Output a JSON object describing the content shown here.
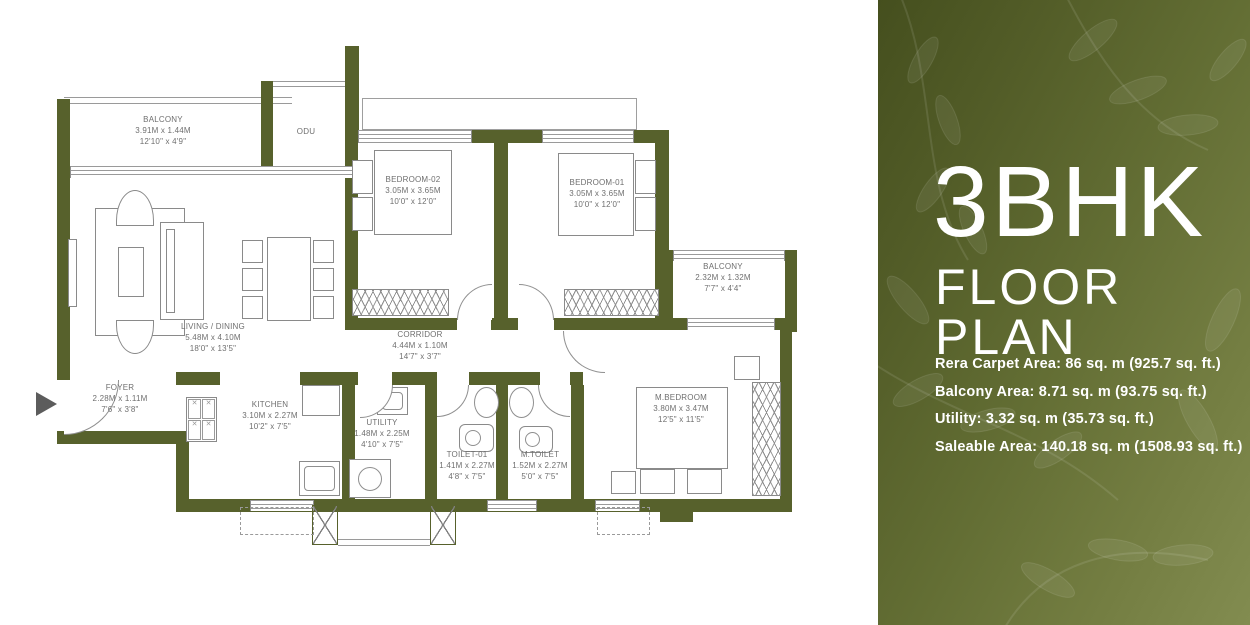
{
  "panel": {
    "title": "3BHK",
    "subtitle": "FLOOR PLAN",
    "details": [
      "Rera Carpet Area: 86 sq. m (925.7 sq. ft.)",
      "Balcony Area: 8.71 sq. m (93.75 sq. ft.)",
      "Utility: 3.32 sq. m (35.73 sq. ft.)",
      "Saleable Area: 140.18 sq. m (1508.93 sq. ft.)"
    ],
    "colors": {
      "panel_dark": "#454f1e",
      "panel_light": "#828c50",
      "text": "#ffffff"
    }
  },
  "plan": {
    "colors": {
      "wall": "#57612c",
      "furniture_line": "#8a8a8a",
      "label_text": "#6f6f6f"
    },
    "rooms": [
      {
        "name": "BALCONY",
        "dim_m": "3.91M x 1.44M",
        "dim_ft": "12'10\" x 4'9\""
      },
      {
        "name": "ODU",
        "dim_m": "",
        "dim_ft": ""
      },
      {
        "name": "BEDROOM-02",
        "dim_m": "3.05M x 3.65M",
        "dim_ft": "10'0\" x 12'0\""
      },
      {
        "name": "BEDROOM-01",
        "dim_m": "3.05M x 3.65M",
        "dim_ft": "10'0\" x 12'0\""
      },
      {
        "name": "BALCONY",
        "dim_m": "2.32M x 1.32M",
        "dim_ft": "7'7\" x 4'4\""
      },
      {
        "name": "LIVING / DINING",
        "dim_m": "5.48M x 4.10M",
        "dim_ft": "18'0\" x 13'5\""
      },
      {
        "name": "CORRIDOR",
        "dim_m": "4.44M x 1.10M",
        "dim_ft": "14'7\" x 3'7\""
      },
      {
        "name": "FOYER",
        "dim_m": "2.28M x 1.11M",
        "dim_ft": "7'6\" x 3'8\""
      },
      {
        "name": "KITCHEN",
        "dim_m": "3.10M x 2.27M",
        "dim_ft": "10'2\" x 7'5\""
      },
      {
        "name": "UTILITY",
        "dim_m": "1.48M x 2.25M",
        "dim_ft": "4'10\" x 7'5\""
      },
      {
        "name": "TOILET-01",
        "dim_m": "1.41M x 2.27M",
        "dim_ft": "4'8\" x 7'5\""
      },
      {
        "name": "M.TOILET",
        "dim_m": "1.52M x 2.27M",
        "dim_ft": "5'0\" x 7'5\""
      },
      {
        "name": "M.BEDROOM",
        "dim_m": "3.80M x 3.47M",
        "dim_ft": "12'5\" x 11'5\""
      }
    ]
  }
}
